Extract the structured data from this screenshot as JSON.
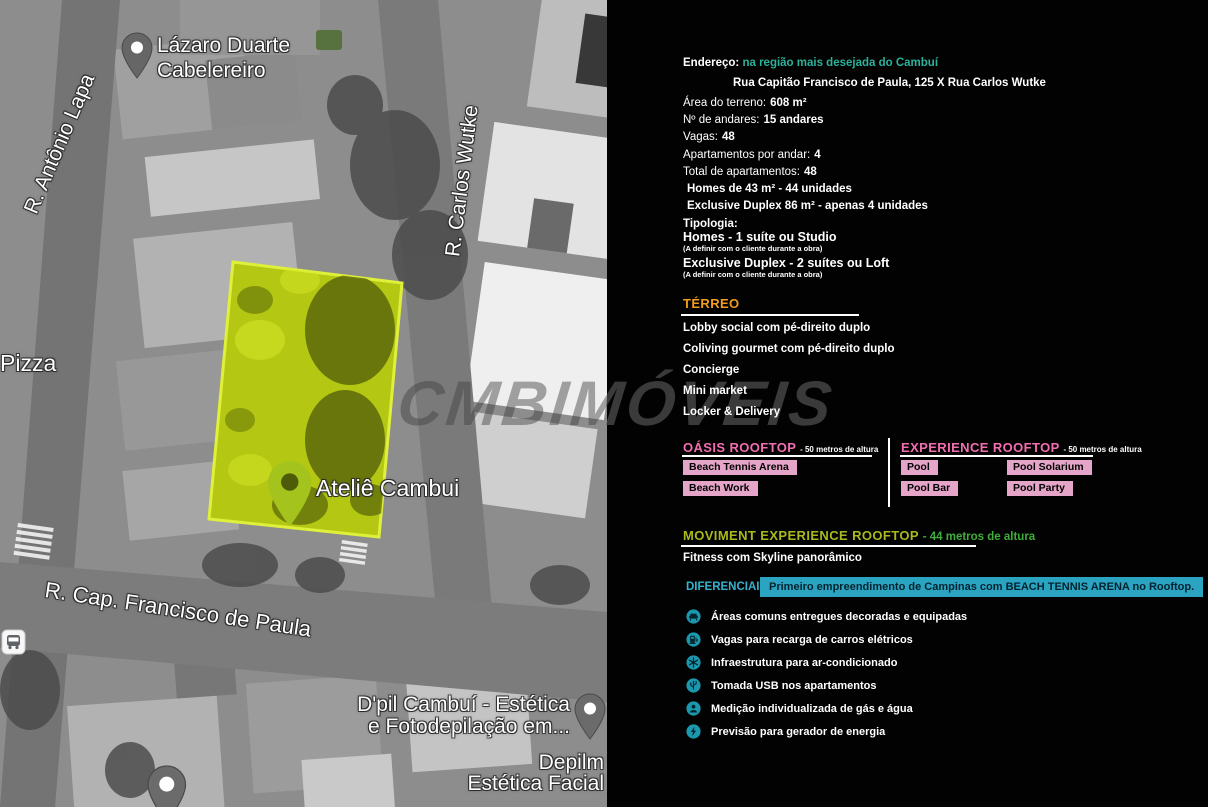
{
  "colors": {
    "teal": "#2bb29b",
    "orange": "#f29b1d",
    "pink": "#f36eb0",
    "pinkbg": "#e5a5c9",
    "olive": "#a9b91c",
    "green": "#3fae3a",
    "cyan": "#35b3cf",
    "cyanbg": "#2ba4c2",
    "icon_teal": "#1b98ae",
    "lot_highlight": "#b4c813"
  },
  "map": {
    "watermark": "CMBIMÓVEIS",
    "labels": {
      "lazaro": "Lázaro Duarte\nCabelereiro",
      "antonio_lapa": "R. Antônio Lapa",
      "carlos_wutke": "R. Carlos Wutke",
      "pizza": "Pizza",
      "atelie": "Ateliê Cambui",
      "francisco": "R. Cap. Francisco de Paula",
      "dpil": "D'pil Cambuí - Estética\ne Fotodepilação em...",
      "depilm": "Depilm\nEstética Facial"
    }
  },
  "panel": {
    "address": {
      "label": "Endereço:",
      "highlight": "na região mais desejada do Cambuí",
      "line2": "Rua Capitão Francisco de Paula, 125 X Rua Carlos Wutke"
    },
    "details": [
      {
        "label": "Área do terreno:",
        "value": "608 m²"
      },
      {
        "label": "Nº de andares:",
        "value": "15 andares"
      },
      {
        "label": "Vagas:",
        "value": "48"
      },
      {
        "label": "Apartamentos por andar:",
        "value": "4"
      },
      {
        "label": "Total de apartamentos:",
        "value": "48"
      },
      {
        "label": "",
        "value": "Homes de 43 m² - 44 unidades"
      },
      {
        "label": "",
        "value": "Exclusive Duplex 86 m² - apenas 4 unidades"
      }
    ],
    "tipologia": {
      "title": "Tipologia:",
      "items": [
        {
          "name": "Homes - 1 suíte ou Studio",
          "note": "(A definir com o cliente durante a obra)"
        },
        {
          "name": "Exclusive Duplex - 2 suítes ou Loft",
          "note": "(A definir com o cliente durante a obra)"
        }
      ]
    },
    "terreo": {
      "title": "TÉRREO",
      "items": [
        "Lobby social com pé-direito duplo",
        "Coliving gourmet com pé-direito duplo",
        "Concierge",
        "Mini market",
        "Locker & Delivery"
      ]
    },
    "rooftops": {
      "oasis": {
        "title": "OÁSIS ROOFTOP",
        "subtitle": "- 50 metros de altura",
        "badges": [
          "Beach Tennis Arena",
          "Beach Work"
        ]
      },
      "experience": {
        "title": "EXPERIENCE ROOFTOP",
        "subtitle": "- 50 metros de altura",
        "badges": [
          "Pool",
          "Pool Solarium",
          "Pool Bar",
          "Pool Party"
        ]
      },
      "moviment": {
        "title": "MOVIMENT EXPERIENCE ROOFTOP",
        "subtitle": "- 44 metros de altura",
        "item": "Fitness com Skyline panorâmico"
      }
    },
    "diferenciais": {
      "label": "DIFERENCIAIS",
      "highlight": "Primeiro empreendimento de Campinas com BEACH TENNIS ARENA no Rooftop."
    },
    "features": {
      "items": [
        {
          "icon": "sofa-icon",
          "label": "Áreas comuns entregues decoradas e equipadas"
        },
        {
          "icon": "ev-charger-icon",
          "label": "Vagas para recarga de carros elétricos"
        },
        {
          "icon": "snowflake-icon",
          "label": "Infraestrutura para ar-condicionado"
        },
        {
          "icon": "usb-icon",
          "label": "Tomada USB nos apartamentos"
        },
        {
          "icon": "gas-water-meter-icon",
          "label": "Medição individualizada de gás e água"
        },
        {
          "icon": "energy-generator-icon",
          "label": "Previsão para gerador de energia"
        }
      ]
    }
  }
}
